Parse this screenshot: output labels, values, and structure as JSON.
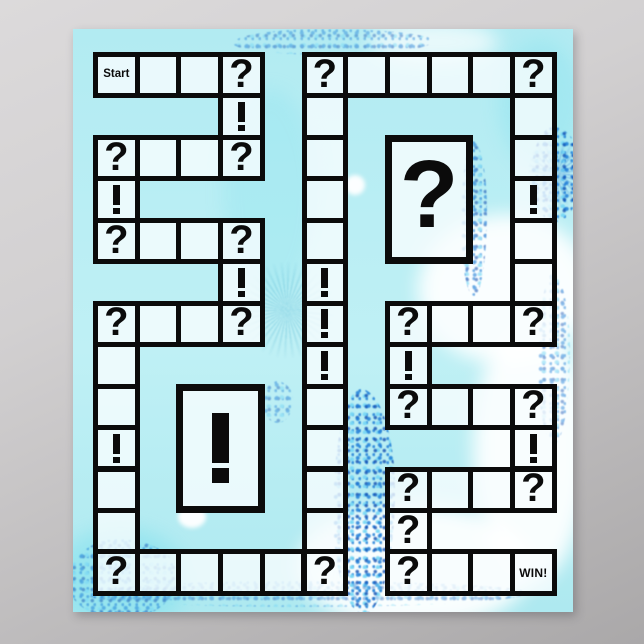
{
  "poster": {
    "description": "Game board poster on gray backdrop",
    "colors": {
      "line": "#0b0b0b",
      "cellfill": "rgba(248,253,254,0.80)",
      "bright": "rgba(122,222,237,0.65)",
      "fblue": "rgba(30,125,215,0.85)",
      "fdeep": "rgba(15,75,175,0.8)",
      "poster_base": "#b7edf3",
      "backdrop_top": "#dcdadb",
      "backdrop_bottom": "#aaa8a9"
    }
  },
  "board": {
    "grid": {
      "cols": 11,
      "rows": 13,
      "origin_x": 20,
      "origin_y": 23,
      "cell_w": 41.7,
      "cell_h": 41.45,
      "border": 5
    },
    "labels": {
      "start": "Start",
      "win": "WIN!",
      "question": "?",
      "exclaim": "!"
    },
    "cells": [
      {
        "col": 0,
        "row": 0,
        "type": "start"
      },
      {
        "col": 1,
        "row": 0,
        "type": "blank"
      },
      {
        "col": 2,
        "row": 0,
        "type": "blank"
      },
      {
        "col": 3,
        "row": 0,
        "type": "question"
      },
      {
        "col": 5,
        "row": 0,
        "type": "question"
      },
      {
        "col": 6,
        "row": 0,
        "type": "blank"
      },
      {
        "col": 7,
        "row": 0,
        "type": "blank"
      },
      {
        "col": 8,
        "row": 0,
        "type": "blank"
      },
      {
        "col": 9,
        "row": 0,
        "type": "blank"
      },
      {
        "col": 10,
        "row": 0,
        "type": "question"
      },
      {
        "col": 3,
        "row": 1,
        "type": "exclaim"
      },
      {
        "col": 5,
        "row": 1,
        "type": "blank"
      },
      {
        "col": 10,
        "row": 1,
        "type": "blank"
      },
      {
        "col": 0,
        "row": 2,
        "type": "question"
      },
      {
        "col": 1,
        "row": 2,
        "type": "blank"
      },
      {
        "col": 2,
        "row": 2,
        "type": "blank"
      },
      {
        "col": 3,
        "row": 2,
        "type": "question"
      },
      {
        "col": 5,
        "row": 2,
        "type": "blank"
      },
      {
        "col": 10,
        "row": 2,
        "type": "blank"
      },
      {
        "col": 0,
        "row": 3,
        "type": "exclaim"
      },
      {
        "col": 5,
        "row": 3,
        "type": "blank"
      },
      {
        "col": 10,
        "row": 3,
        "type": "exclaim"
      },
      {
        "col": 0,
        "row": 4,
        "type": "question"
      },
      {
        "col": 1,
        "row": 4,
        "type": "blank"
      },
      {
        "col": 2,
        "row": 4,
        "type": "blank"
      },
      {
        "col": 3,
        "row": 4,
        "type": "question"
      },
      {
        "col": 5,
        "row": 4,
        "type": "blank"
      },
      {
        "col": 10,
        "row": 4,
        "type": "blank"
      },
      {
        "col": 3,
        "row": 5,
        "type": "exclaim"
      },
      {
        "col": 5,
        "row": 5,
        "type": "exclaim"
      },
      {
        "col": 10,
        "row": 5,
        "type": "blank"
      },
      {
        "col": 0,
        "row": 6,
        "type": "question"
      },
      {
        "col": 1,
        "row": 6,
        "type": "blank"
      },
      {
        "col": 2,
        "row": 6,
        "type": "blank"
      },
      {
        "col": 3,
        "row": 6,
        "type": "question"
      },
      {
        "col": 5,
        "row": 6,
        "type": "exclaim"
      },
      {
        "col": 7,
        "row": 6,
        "type": "question"
      },
      {
        "col": 8,
        "row": 6,
        "type": "blank"
      },
      {
        "col": 9,
        "row": 6,
        "type": "blank"
      },
      {
        "col": 10,
        "row": 6,
        "type": "question"
      },
      {
        "col": 0,
        "row": 7,
        "type": "blank"
      },
      {
        "col": 5,
        "row": 7,
        "type": "exclaim"
      },
      {
        "col": 7,
        "row": 7,
        "type": "exclaim"
      },
      {
        "col": 0,
        "row": 8,
        "type": "blank"
      },
      {
        "col": 5,
        "row": 8,
        "type": "blank"
      },
      {
        "col": 7,
        "row": 8,
        "type": "question"
      },
      {
        "col": 8,
        "row": 8,
        "type": "blank"
      },
      {
        "col": 9,
        "row": 8,
        "type": "blank"
      },
      {
        "col": 10,
        "row": 8,
        "type": "question"
      },
      {
        "col": 0,
        "row": 9,
        "type": "exclaim"
      },
      {
        "col": 5,
        "row": 9,
        "type": "blank"
      },
      {
        "col": 10,
        "row": 9,
        "type": "exclaim"
      },
      {
        "col": 0,
        "row": 10,
        "type": "blank"
      },
      {
        "col": 5,
        "row": 10,
        "type": "blank"
      },
      {
        "col": 7,
        "row": 10,
        "type": "question"
      },
      {
        "col": 8,
        "row": 10,
        "type": "blank"
      },
      {
        "col": 9,
        "row": 10,
        "type": "blank"
      },
      {
        "col": 10,
        "row": 10,
        "type": "question"
      },
      {
        "col": 0,
        "row": 11,
        "type": "blank"
      },
      {
        "col": 5,
        "row": 11,
        "type": "blank"
      },
      {
        "col": 7,
        "row": 11,
        "type": "question"
      },
      {
        "col": 0,
        "row": 12,
        "type": "question"
      },
      {
        "col": 1,
        "row": 12,
        "type": "blank"
      },
      {
        "col": 2,
        "row": 12,
        "type": "blank"
      },
      {
        "col": 3,
        "row": 12,
        "type": "blank"
      },
      {
        "col": 4,
        "row": 12,
        "type": "blank"
      },
      {
        "col": 5,
        "row": 12,
        "type": "question"
      },
      {
        "col": 7,
        "row": 12,
        "type": "question"
      },
      {
        "col": 8,
        "row": 12,
        "type": "blank"
      },
      {
        "col": 9,
        "row": 12,
        "type": "blank"
      },
      {
        "col": 10,
        "row": 12,
        "type": "win"
      }
    ],
    "big_boxes": [
      {
        "symbol": "question",
        "col": 7,
        "row": 2,
        "cols": 2,
        "rows": 3
      },
      {
        "symbol": "exclaim",
        "col": 2,
        "row": 8,
        "cols": 2,
        "rows": 3
      }
    ]
  }
}
